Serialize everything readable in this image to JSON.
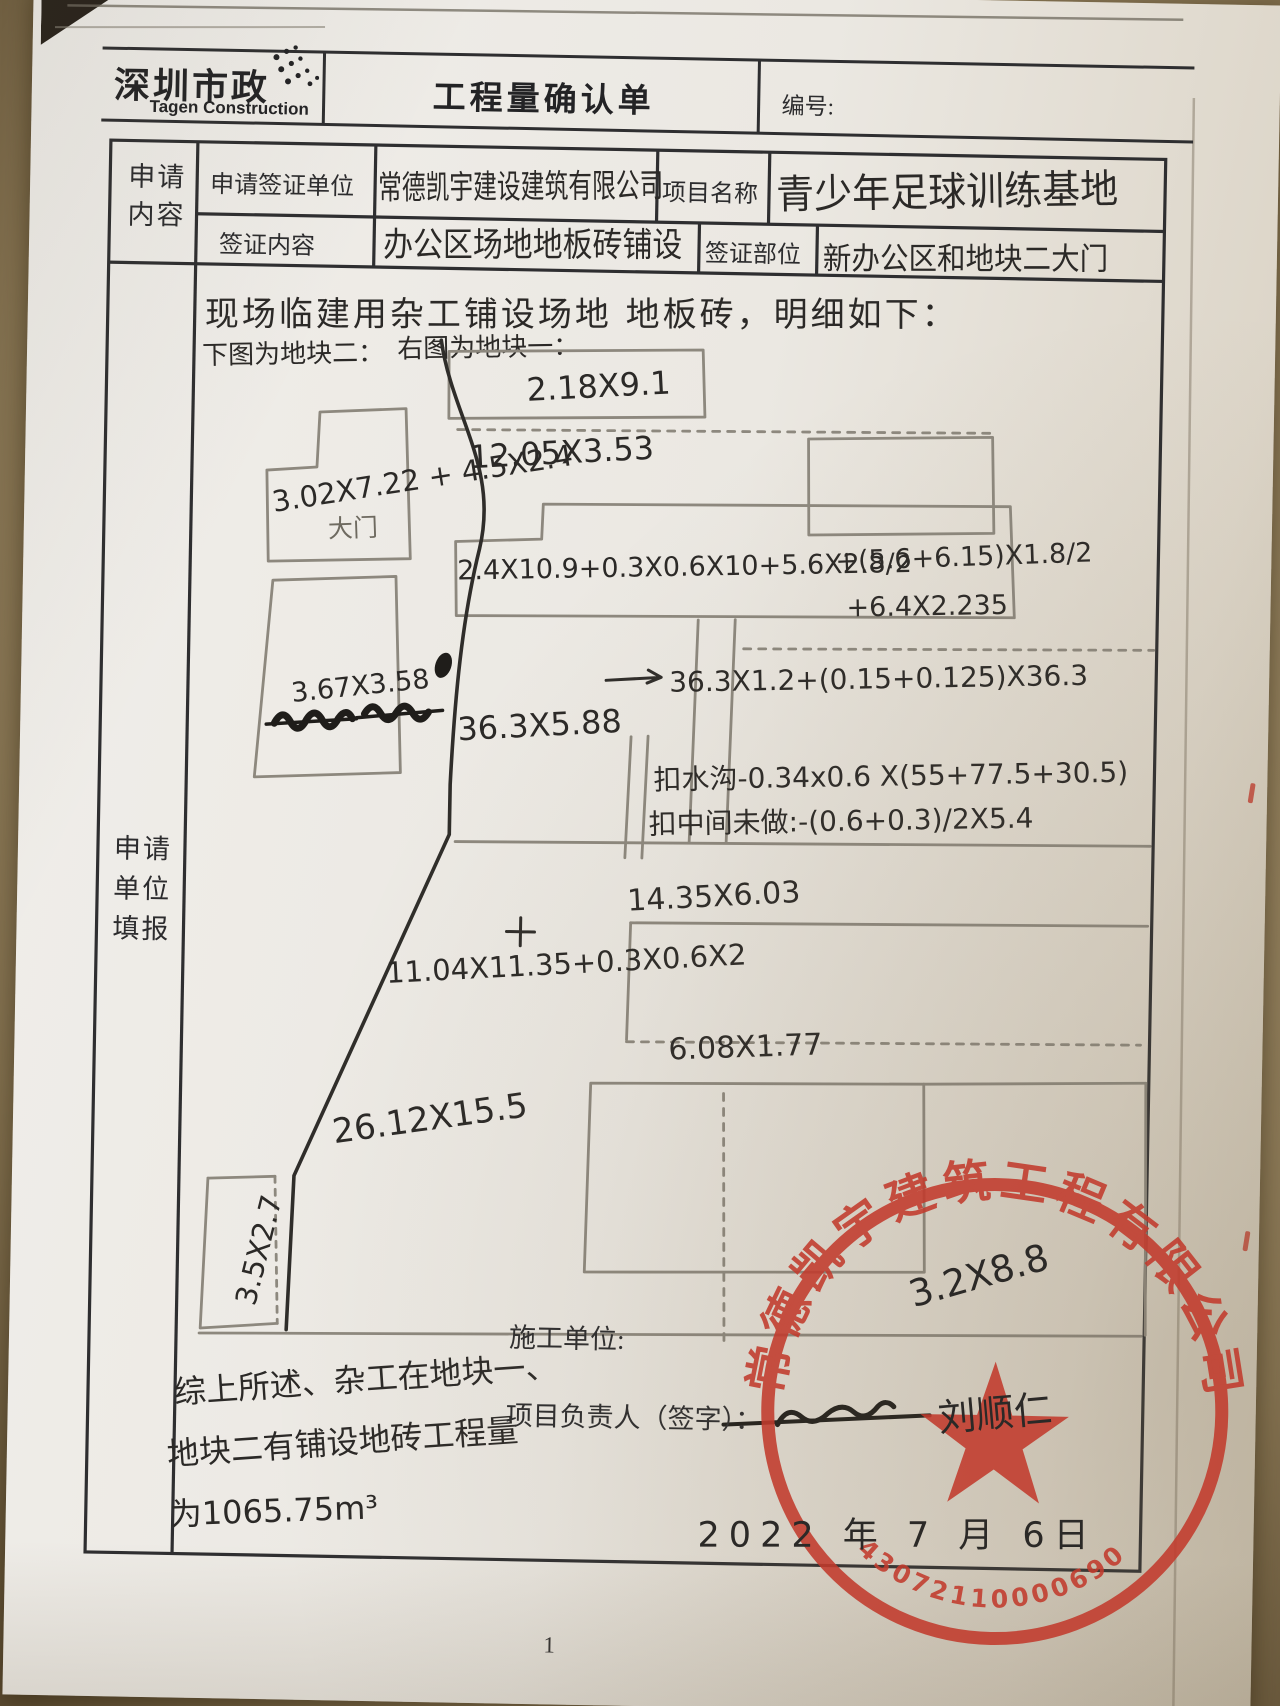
{
  "header": {
    "logo_cn": "深圳市政",
    "logo_en": "Tagen Construction",
    "title": "工程量确认单",
    "number_label": "编号:"
  },
  "form": {
    "section_label_top_1": "申请",
    "section_label_top_2": "内容",
    "section_label_main_1": "申请",
    "section_label_main_2": "单位",
    "section_label_main_3": "填报",
    "apply_unit_label": "申请签证单位",
    "apply_unit_value": "常德凯宇建设建筑有限公司",
    "project_name_label": "项目名称",
    "project_name_value": "青少年足球训练基地",
    "visa_content_label": "签证内容",
    "visa_content_value": "办公区场地地板砖铺设",
    "visa_part_label": "签证部位",
    "visa_part_value": "新办公区和地块二大门"
  },
  "body": {
    "intro_line": "现场临建用杂工铺设场地 地板砖，明细如下：",
    "left_caption": "下图为地块二：",
    "right_caption": "右图为地块一：",
    "gate_label": "大门",
    "measurements": {
      "m1": "2.18X9.1",
      "m2": "12.05X3.53",
      "m3": "3.02X7.22 + 4.5X2.4",
      "m4": "2.4X10.9+0.3X0.6X10+5.6X2.8/2",
      "m5": "+(5.6+6.15)X1.8/2",
      "m6": "+6.4X2.235",
      "m7": "3.67X3.58",
      "m8": "36.3X5.88",
      "m9": "36.3X1.2+(0.15+0.125)X36.3",
      "m10": "扣水沟-0.34x0.6 X(55+77.5+30.5)",
      "m11": "扣中间未做:-(0.6+0.3)/2X5.4",
      "m12": "14.35X6.03",
      "m13": "11.04X11.35+0.3X0.6X2",
      "m14": "6.08X1.77",
      "m15": "26.12X15.5",
      "m16": "3.5X2.7",
      "m17": "3.2X8.8"
    },
    "summary_line1": "综上所述、杂工在地块一、",
    "summary_line2": "地块二有铺设地砖工程量",
    "summary_line3": "为1065.75m³"
  },
  "footer": {
    "builder_label": "施工单位:",
    "manager_label": "项目负责人（签字）：",
    "signature": "刘顺仁",
    "date": "2022 年 7 月 6日",
    "page_number": "1"
  },
  "stamp": {
    "company": "常德凯宇建筑工程有限公司",
    "number": "43072110000690",
    "color": "#c23b2d"
  },
  "colors": {
    "pencil": "#8d887e",
    "ink": "#2b2927",
    "stamp_red": "#c23b2d",
    "paper": "#ebe8e2"
  }
}
